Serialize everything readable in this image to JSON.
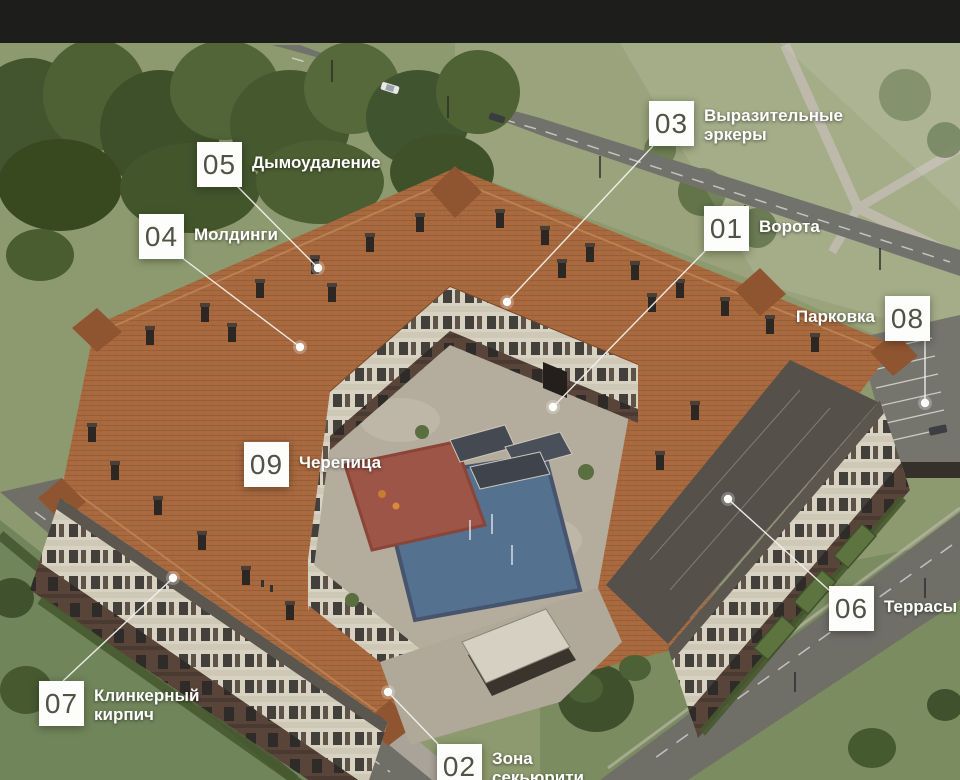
{
  "callouts": {
    "c01": {
      "number": "01",
      "label": "Ворота"
    },
    "c02": {
      "number": "02",
      "label": "Зона\nсекьюрити"
    },
    "c03": {
      "number": "03",
      "label": "Выразительные\nэркеры"
    },
    "c04": {
      "number": "04",
      "label": "Молдинги"
    },
    "c05": {
      "number": "05",
      "label": "Дымоудаление"
    },
    "c06": {
      "number": "06",
      "label": "Террасы"
    },
    "c07": {
      "number": "07",
      "label": "Клинкерный\nкирпич"
    },
    "c08": {
      "number": "08",
      "label": "Парковка"
    },
    "c09": {
      "number": "09",
      "label": "Черепица"
    }
  },
  "colors": {
    "number_text": "#4f5244",
    "callout_box": "#fdfdfc",
    "label_text": "#ffffff",
    "roof_tile": "#a96a40",
    "top_bar": "#1d1d1b"
  }
}
